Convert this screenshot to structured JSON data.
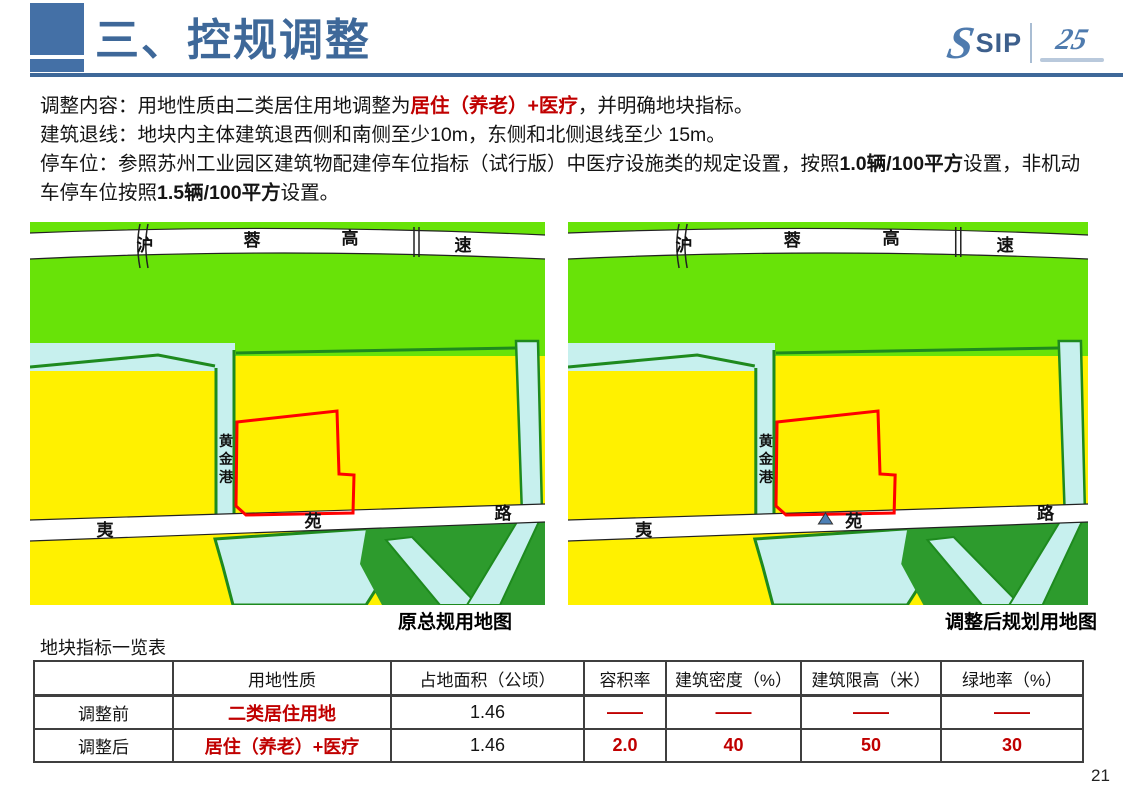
{
  "slide": {
    "title": "三、控规调整",
    "page_number": "21"
  },
  "logo": {
    "swoosh": "S",
    "sip": "SIP",
    "anniversary": "25"
  },
  "body": {
    "p1_prefix": "调整内容：用地性质由二类居住用地调整为",
    "p1_highlight": "居住（养老）+医疗",
    "p1_suffix": "，并明确地块指标。",
    "p2": "建筑退线：地块内主体建筑退西侧和南侧至少10m，东侧和北侧退线至少 15m。",
    "p3_prefix": "停车位：参照苏州工业园区建筑物配建停车位指标（试行版）中医疗设施类的规定设置，按照",
    "p3_bold1": "1.0辆/100平方",
    "p3_mid": "设置，非机动车停车位按照",
    "p3_bold2": "1.5辆/100平方",
    "p3_suffix": "设置。"
  },
  "maps": {
    "left_caption": "原总规用地图",
    "right_caption": "调整后规划用地图",
    "highway_chars": [
      "沪",
      "蓉",
      "高",
      "速"
    ],
    "river_chars": [
      "黄",
      "金",
      "港"
    ],
    "road_chars": [
      "夷",
      "苑",
      "路"
    ],
    "colors": {
      "farmland_green": "#68E308",
      "water_cyan": "#C7F0EE",
      "border_green": "#1E8A1E",
      "forest_green": "#2D9B2D",
      "residential_yellow": "#FFF100",
      "plot_outline_red": "#FF0000",
      "marker_blue": "#4C7FB5",
      "road_white": "#FFFFFF"
    }
  },
  "table": {
    "caption": "地块指标一览表",
    "headers": [
      "",
      "用地性质",
      "占地面积（公顷）",
      "容积率",
      "建筑密度（%）",
      "建筑限高（米）",
      "绿地率（%）"
    ],
    "rows": [
      [
        "调整前",
        "二类居住用地",
        "1.46",
        "——",
        "——",
        "——",
        "——"
      ],
      [
        "调整后",
        "居住（养老）+医疗",
        "1.46",
        "2.0",
        "40",
        "50",
        "30"
      ]
    ]
  },
  "accent": {
    "title_blue": "#3E6899",
    "highlight_red": "#C00000"
  }
}
